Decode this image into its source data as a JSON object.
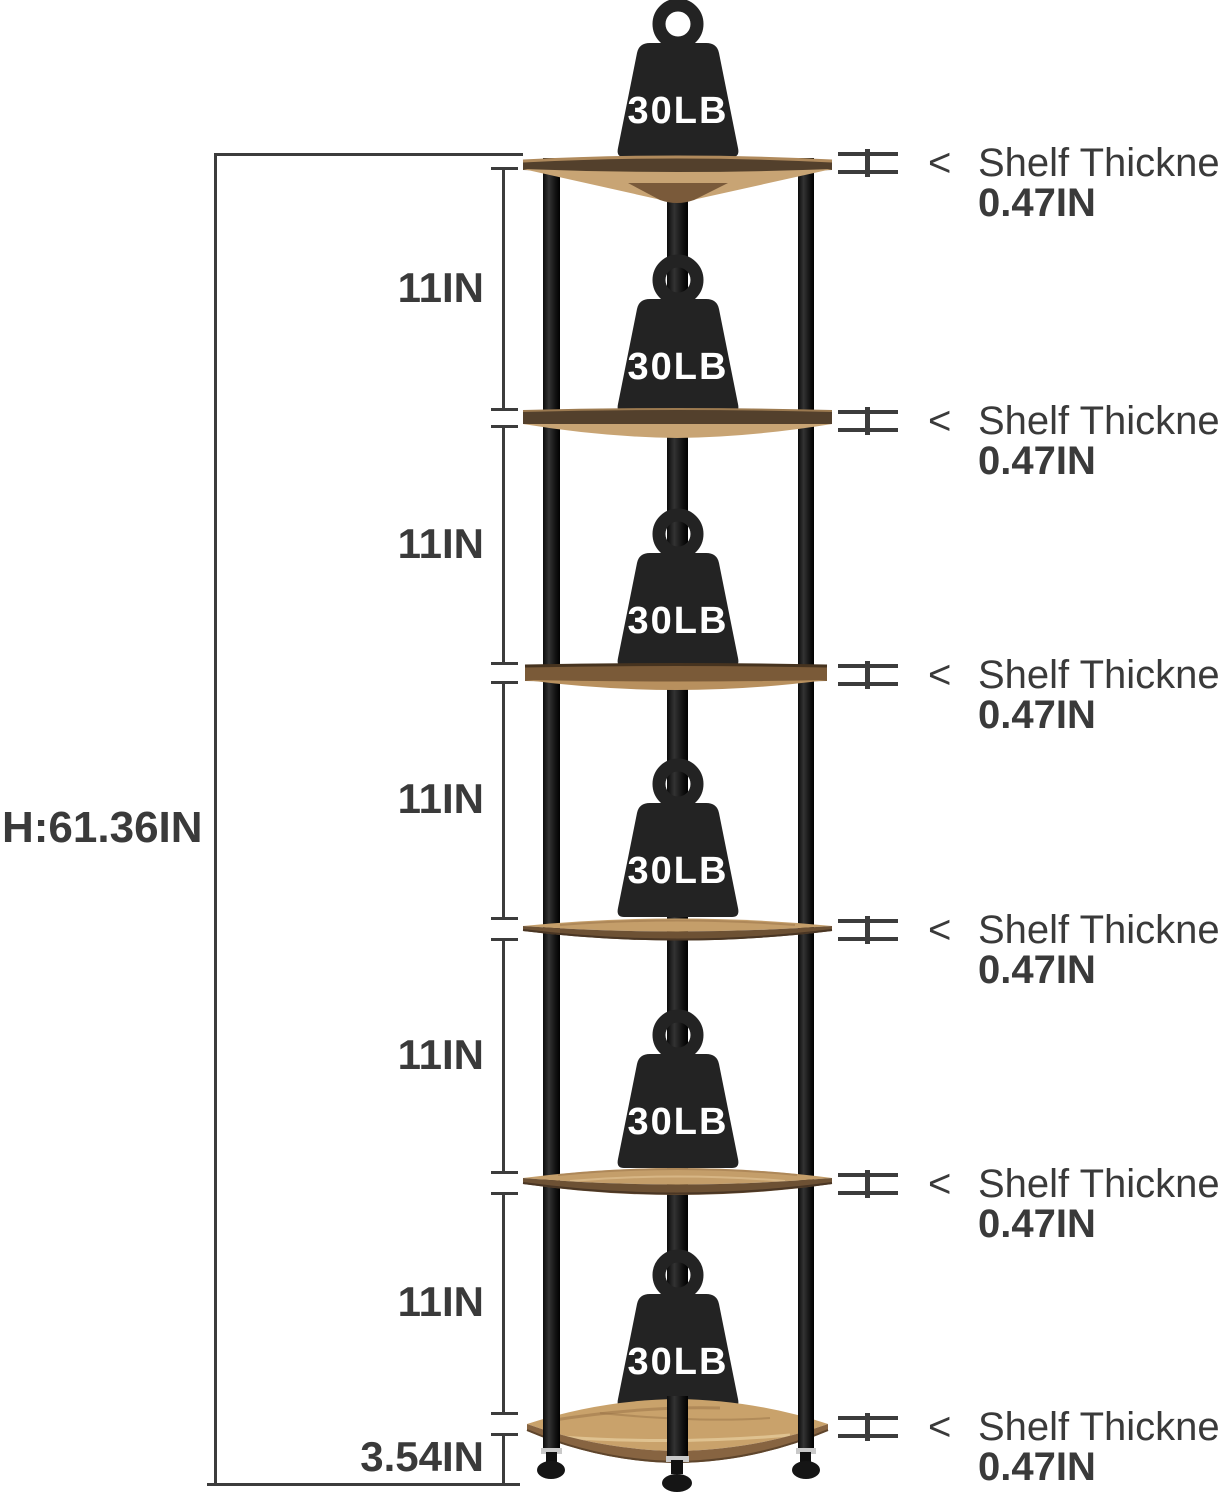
{
  "unit": {
    "height_label": "H:61.36IN",
    "gap_labels": [
      "11IN",
      "11IN",
      "11IN",
      "11IN",
      "11IN"
    ],
    "bottom_gap_label": "3.54IN",
    "weight_label": "30LB",
    "thickness_labels": [
      {
        "arrow": "<",
        "title": "Shelf Thickne",
        "value": "0.47IN"
      },
      {
        "arrow": "<",
        "title": "Shelf Thickne",
        "value": "0.47IN"
      },
      {
        "arrow": "<",
        "title": "Shelf Thickne",
        "value": "0.47IN"
      },
      {
        "arrow": "<",
        "title": "Shelf Thickne",
        "value": "0.47IN"
      },
      {
        "arrow": "<",
        "title": "Shelf Thickne",
        "value": "0.47IN"
      },
      {
        "arrow": "<",
        "title": "Shelf Thickne",
        "value": "0.47IN"
      }
    ]
  },
  "colors": {
    "dimension_gray": "#3c3c3c",
    "text_gray": "#3a3a3a",
    "wood_light": "#c9a26b",
    "wood_mid": "#7a5a38",
    "wood_dark": "#53402c",
    "leg_black": "#181818",
    "weight_black": "#232323",
    "weight_text": "#ffffff",
    "foot_chrome": "#c9c9c9"
  }
}
